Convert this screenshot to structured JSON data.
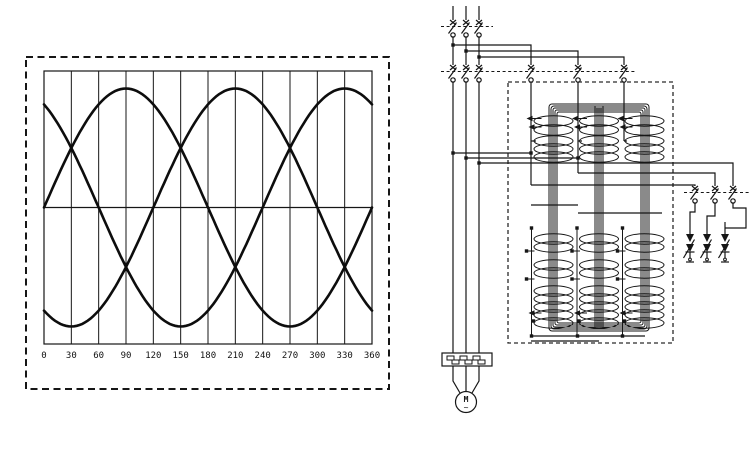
{
  "colors": {
    "ink": "#161616",
    "background": "#ffffff"
  },
  "chart_data": {
    "type": "line",
    "title": "",
    "xlabel": "",
    "ylabel": "",
    "x_range": [
      0,
      360
    ],
    "y_range": [
      -1,
      1
    ],
    "x_ticks": [
      "0",
      "30",
      "60",
      "90",
      "120",
      "150",
      "180",
      "210",
      "240",
      "270",
      "300",
      "330",
      "360"
    ],
    "x_tick_values": [
      0,
      30,
      60,
      90,
      120,
      150,
      180,
      210,
      240,
      270,
      300,
      330,
      360
    ],
    "grid": "vertical lines every 30 degrees, horizontal zero axis",
    "legend_position": "none",
    "amplitude": 1,
    "series": [
      {
        "name": "phase-a",
        "function": "sine",
        "phase_deg": 0,
        "peak_at_deg": 90
      },
      {
        "name": "phase-b",
        "function": "sine",
        "phase_deg": -120,
        "peak_at_deg": 210
      },
      {
        "name": "phase-c",
        "function": "sine",
        "phase_deg": 120,
        "peak_at_deg": 330
      }
    ]
  },
  "circuit": {
    "description": "three-phase transformer motor starter schematic",
    "phase_count": 3,
    "breaker_row_count": 2,
    "transformer_leg_count": 3,
    "tap_switch_count": 3,
    "thyristor_count": 3,
    "motor_label": "M",
    "motor_wave_label": "~"
  }
}
